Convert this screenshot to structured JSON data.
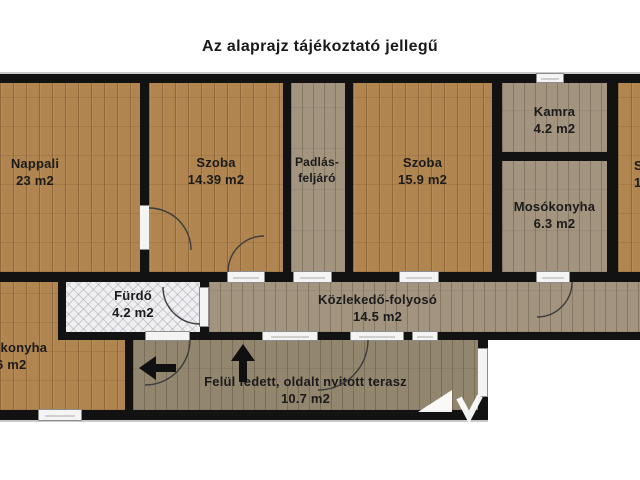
{
  "title": "Az alaprajz tájékoztató jellegű",
  "rooms": {
    "nappali": {
      "name": "Nappali",
      "area": "23 m2"
    },
    "szoba1": {
      "name": "Szoba",
      "area": "14.39 m2"
    },
    "padlas": {
      "name": "Padlás-",
      "name2": "feljáró"
    },
    "szoba2": {
      "name": "Szoba",
      "area": "15.9 m2"
    },
    "kamra": {
      "name": "Kamra",
      "area": "4.2 m2"
    },
    "mosokonyha": {
      "name": "Mosókonyha",
      "area": "6.3 m2"
    },
    "furdo": {
      "name": "Fürdő",
      "area": "4.2 m2"
    },
    "kozlekedo": {
      "name": "Közlekedő-folyosó",
      "area": "14.5 m2"
    },
    "konyha_partial": {
      "name": "-konyha",
      "area": "6 m2"
    },
    "terasz": {
      "name": "Felül fedett, oldalt nyitott terasz",
      "area": "10.7 m2"
    },
    "szoba_partial": {
      "name": "S",
      "area": "1"
    }
  },
  "colors": {
    "wall": "#121212",
    "wood_floor": "#b1854f",
    "grey_wood_floor": "#a2947f",
    "bath_tile": "#efeef0",
    "text": "#1b1b1b"
  }
}
